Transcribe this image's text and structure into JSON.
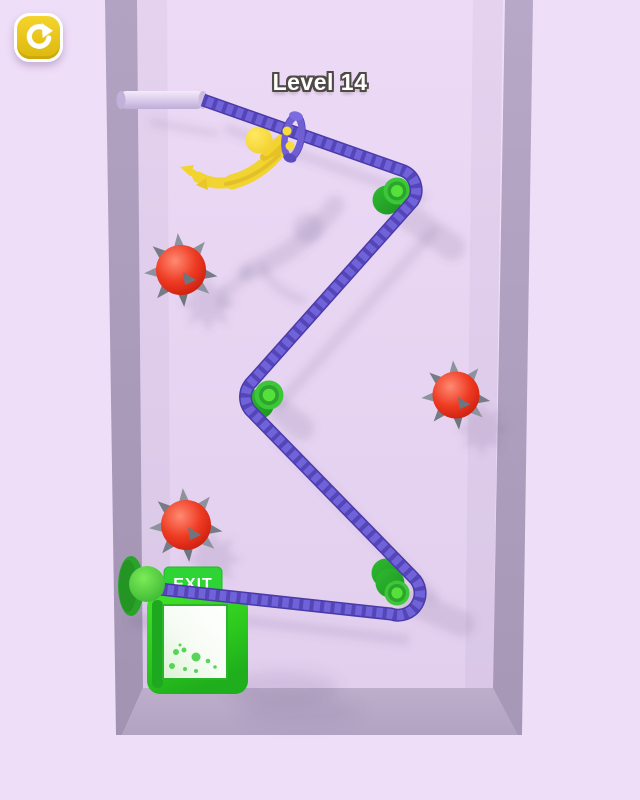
{
  "title": {
    "level_label": "Level 14"
  },
  "hud": {
    "restart_icon": "restart-icon"
  },
  "exit_door": {
    "sign_label": "EXIT"
  },
  "scene": {
    "character": "yellow stickman hanging from rope handle",
    "anchor": "wall pin top-left",
    "pulley_count": 3,
    "mine_count": 3
  },
  "palette": {
    "background_outer": "#efdef8",
    "background_wall": "#e8d6f2",
    "wall_edge": "#ab9cba",
    "rope": "#7062d8",
    "rope_dark": "#4a3aa8",
    "peg_green": "#3bc737",
    "peg_green_dark": "#28a22b",
    "peg_green_light": "#55e03a",
    "mine_red": "#e02718",
    "spike_gray": "#8d939e",
    "character_yellow": "#f2d431",
    "handle_purple": "#6f5fd2",
    "pin_lavender": "#d9c9ea",
    "button_yellow": "#e7c41a",
    "exit_sign_green": "#2ed334",
    "door_green": "#2ecb1e",
    "door_panel": "#f7fdf5",
    "shadow": "#6d5a86",
    "text_white": "#ffffff"
  }
}
